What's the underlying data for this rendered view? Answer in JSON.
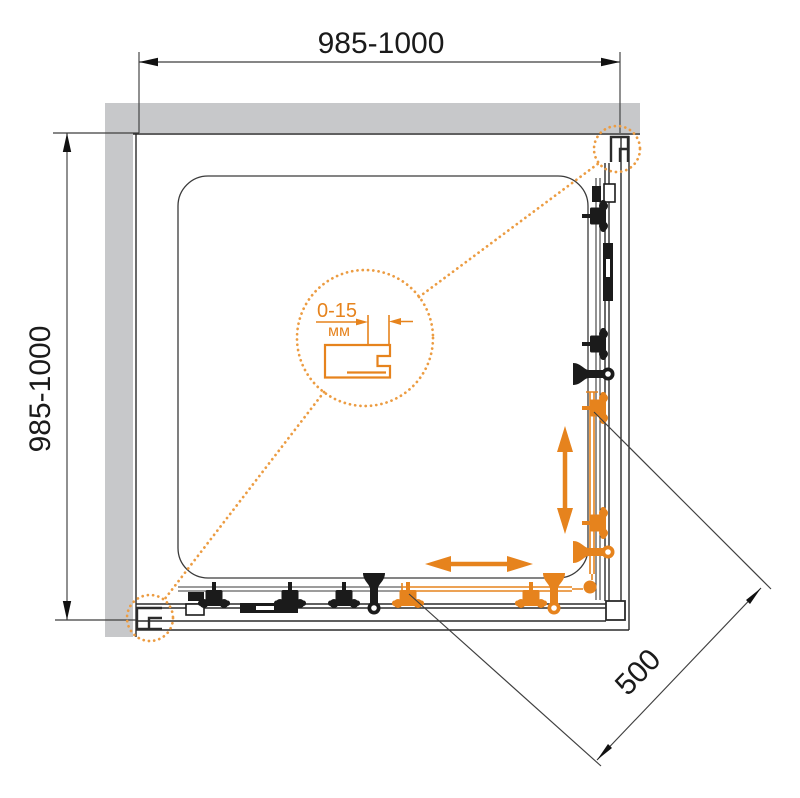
{
  "dimensions": {
    "top": "985-1000",
    "left": "985-1000",
    "entry_diagonal": "500"
  },
  "detail": {
    "adjustment_range": "0-15",
    "unit": "мм"
  },
  "colors": {
    "accent": "#E6831D",
    "accent_dots": "#EC9C42",
    "wall": "#C7C8CA",
    "line": "#2B2B2B",
    "hardware": "#1B1B1B",
    "dim_text": "#1A1A1A"
  }
}
